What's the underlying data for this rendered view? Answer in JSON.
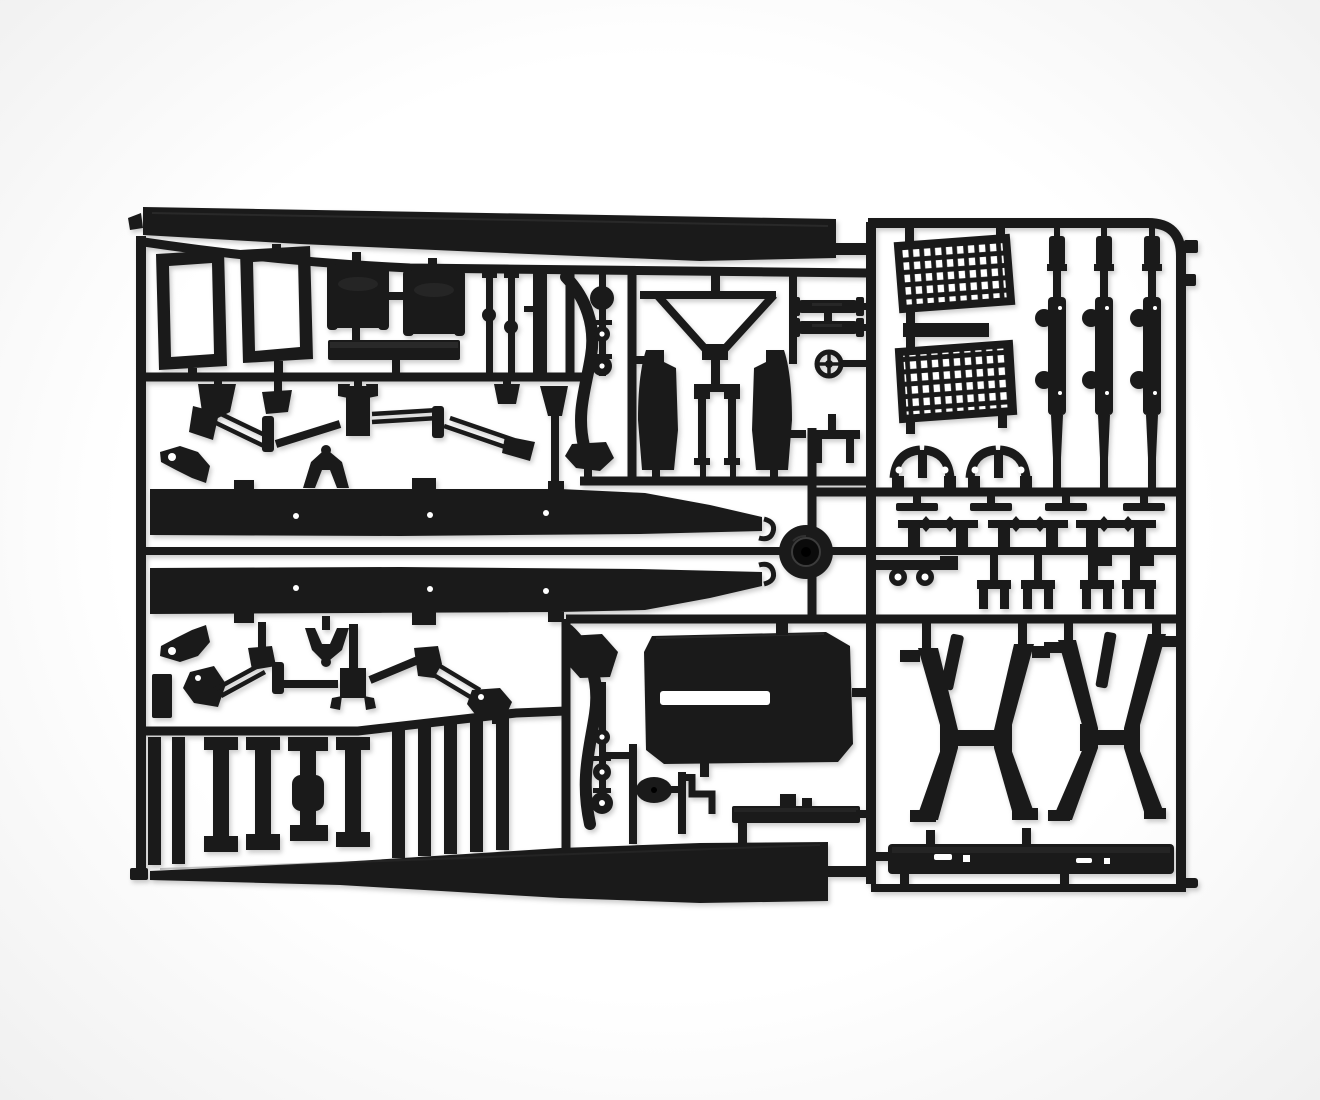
{
  "meta": {
    "type": "product-photo",
    "description": "Black injection-molded styrene sprue (parts tree) from a 1/24 scale model truck kit, photographed flat on a seamless white background. The tree holds chassis side rails, fuel tanks, window frames, suspension wishbones, leaf springs, mesh grille panels, fenders, a steering wheel, trestle supports, a bumper bar and many small fittings, all joined by rectangular runner channels.",
    "subject": "model-kit-sprue",
    "plastic_finish": "matte black styrene with slight sheen highlights"
  },
  "colors": {
    "background": "#ffffff",
    "vignette": "#f0f0f0",
    "plastic": "#1a1a1a",
    "plastic_deep": "#0b0b0b",
    "plastic_sheen": "#3c3c3c",
    "hole": "#ffffff",
    "shadow": "rgba(0,0,0,0.20)"
  },
  "sprue": {
    "material": "black styrene",
    "sections": {
      "left": {
        "parts": [
          {
            "name": "roof-panel",
            "count": 1
          },
          {
            "name": "window-frame",
            "count": 2
          },
          {
            "name": "fuel-tank",
            "count": 2
          },
          {
            "name": "stowage-plank",
            "count": 1
          },
          {
            "name": "tie-rod",
            "count": 3
          },
          {
            "name": "wishbone-linkage",
            "count": 2
          },
          {
            "name": "shackle-claw",
            "count": 2
          },
          {
            "name": "rail-hook",
            "count": 2
          },
          {
            "name": "chassis-rail",
            "count": 2
          },
          {
            "name": "leaf-slat",
            "count": 11
          },
          {
            "name": "axle-stand",
            "count": 1
          },
          {
            "name": "floor-wedge-panel",
            "count": 1
          }
        ]
      },
      "middle": {
        "parts": [
          {
            "name": "drag-link-arm",
            "count": 2
          },
          {
            "name": "ball-joint-column",
            "count": 2
          },
          {
            "name": "radiator-a-frame",
            "count": 1
          },
          {
            "name": "fender-half",
            "count": 2
          },
          {
            "name": "shock-absorber",
            "count": 2
          },
          {
            "name": "steering-wheel",
            "count": 1
          },
          {
            "name": "mounting-bracket",
            "count": 1
          },
          {
            "name": "pedal-bracket",
            "count": 1
          },
          {
            "name": "engine-hood-panel",
            "count": 1
          },
          {
            "name": "horn-disc",
            "count": 1
          },
          {
            "name": "brake-pipe",
            "count": 1
          },
          {
            "name": "sill-plate",
            "count": 1
          },
          {
            "name": "central-hub",
            "count": 1
          }
        ]
      },
      "right": {
        "parts": [
          {
            "name": "mesh-grille",
            "count": 2
          },
          {
            "name": "grille-connector",
            "count": 1
          },
          {
            "name": "leaf-spring",
            "count": 3
          },
          {
            "name": "pipe-clamp",
            "count": 2
          },
          {
            "name": "valve-fitting",
            "count": 4
          },
          {
            "name": "manifold-fitting",
            "count": 3
          },
          {
            "name": "shackle-plate",
            "count": 1
          },
          {
            "name": "frame-staple",
            "count": 4
          },
          {
            "name": "trestle-support",
            "count": 2
          },
          {
            "name": "support-stick",
            "count": 2
          },
          {
            "name": "bumper-bar",
            "count": 1
          },
          {
            "name": "sprue-tab",
            "count": 2
          },
          {
            "name": "sprue-foot",
            "count": 1
          }
        ]
      }
    }
  }
}
